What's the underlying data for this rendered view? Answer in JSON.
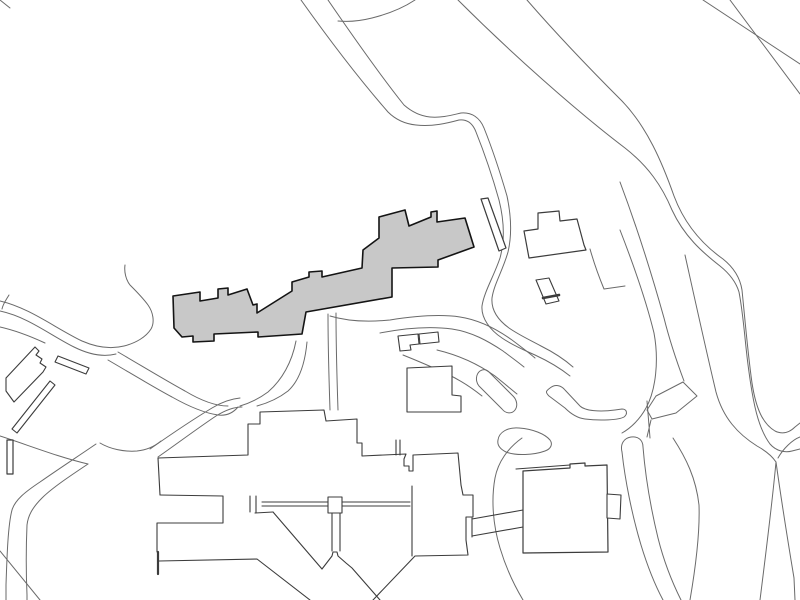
{
  "canvas": {
    "width": 800,
    "height": 600,
    "background": "#ffffff"
  },
  "palette": {
    "road_stroke": "#6a6a6a",
    "building_stroke": "#3c3c3c",
    "highlight_fill": "#c8c8c8",
    "highlight_stroke": "#141414",
    "white_fill": "#ffffff"
  },
  "shapes": [
    {
      "name": "corner-tick-road",
      "kind": "road",
      "fill": "none",
      "stroke": "#6a6a6a",
      "width": 1,
      "d": "M0,0 L10,8"
    },
    {
      "name": "road-top-right-edge-1",
      "kind": "road",
      "fill": "none",
      "stroke": "#6a6a6a",
      "width": 1,
      "d": "M703,0 L800,64"
    },
    {
      "name": "road-top-right-edge-2",
      "kind": "road",
      "fill": "none",
      "stroke": "#6a6a6a",
      "width": 1,
      "d": "M730,0 L800,94"
    },
    {
      "name": "main-road-edge-west",
      "kind": "road",
      "fill": "none",
      "stroke": "#6a6a6a",
      "width": 1,
      "d": "M458,0 C510,52 575,110 625,148 C648,166 662,186 672,210 C684,236 702,252 720,266 C730,274 736,282 739,292 C744,318 745,345 749,372 C753,402 758,428 770,444 C776,451 785,453 792,451 L800,449"
    },
    {
      "name": "main-road-edge-east",
      "kind": "road",
      "fill": "none",
      "stroke": "#6a6a6a",
      "width": 1,
      "d": "M527,0 C560,38 595,74 622,101 C647,127 662,162 674,196 C686,228 706,247 723,259 C733,267 740,277 742,290 C745,320 748,355 752,383 C756,409 763,424 775,431 C783,435 790,432 795,427 L800,423"
    },
    {
      "name": "road-branch-inner-edge",
      "kind": "road",
      "fill": "none",
      "stroke": "#6a6a6a",
      "width": 1,
      "d": "M685,255 C695,300 706,350 716,392 C723,418 738,434 757,446 C766,451 772,456 776,462 C772,505 766,552 760,600"
    },
    {
      "name": "road-crossing-from-right",
      "kind": "road",
      "fill": "none",
      "stroke": "#6a6a6a",
      "width": 1,
      "d": "M800,437 C792,440 783,449 778,458"
    },
    {
      "name": "road-descender-right",
      "kind": "road",
      "fill": "none",
      "stroke": "#6a6a6a",
      "width": 1,
      "d": "M776,462 C782,505 789,548 794,578 L795,600"
    },
    {
      "name": "road-curve-c-edge",
      "kind": "road",
      "fill": "none",
      "stroke": "#6a6a6a",
      "width": 1,
      "d": "M620,182 C638,230 652,275 664,318 C670,342 678,365 684,381"
    },
    {
      "name": "road-curve-d-edge",
      "kind": "road",
      "fill": "none",
      "stroke": "#6a6a6a",
      "width": 1,
      "d": "M620,230 C634,266 646,300 654,333 C659,360 656,390 646,408 C640,419 631,428 622,433"
    },
    {
      "name": "median-island-left-edge",
      "kind": "road",
      "fill": "none",
      "stroke": "#6a6a6a",
      "width": 1,
      "d": "M622,452 C620,444 624,438 631,437 C638,436 643,440 643,447 C645,472 650,505 658,538 C664,562 672,582 681,600"
    },
    {
      "name": "median-island-right-edge",
      "kind": "road",
      "fill": "none",
      "stroke": "#6a6a6a",
      "width": 1,
      "d": "M622,452 C625,480 632,515 641,545 C648,568 655,585 663,600"
    },
    {
      "name": "road-center-descender",
      "kind": "road",
      "fill": "none",
      "stroke": "#6a6a6a",
      "width": 1,
      "d": "M673,438 C686,458 696,478 699,505 C700,532 696,565 690,600"
    },
    {
      "name": "road-island-connector",
      "kind": "road",
      "fill": "none",
      "stroke": "#6a6a6a",
      "width": 1,
      "d": "M651,420 L647,437 M647,401 C648,414 649,426 650,438"
    },
    {
      "name": "junction-arrow-island",
      "kind": "island",
      "fill": "none",
      "stroke": "#6a6a6a",
      "width": 1,
      "d": "M683,382 L697,396 L676,413 L652,419 L647,410 L656,396 Z"
    },
    {
      "name": "junction-boomerang-island",
      "kind": "island",
      "fill": "none",
      "stroke": "#6a6a6a",
      "width": 1,
      "d": "M550,388 C555,384 561,385 565,390 L580,406 C585,411 600,412 615,410 L622,409 C627,409 628,414 624,417 C619,420 600,421 585,419 C577,418 570,413 565,408 L549,396 C545,392 546,391 550,388 Z"
    },
    {
      "name": "walkway-capsule-island",
      "kind": "island",
      "fill": "none",
      "stroke": "#6a6a6a",
      "width": 1,
      "d": "M480,371 C476,374 475,381 479,386 L502,409 C506,414 512,414 515,410 C518,406 517,400 513,396 L489,372 C486,369 483,369 480,371 Z"
    },
    {
      "name": "pond",
      "kind": "pond",
      "fill": "#ffffff",
      "stroke": "#6a6a6a",
      "width": 1,
      "d": "M498,440 C499,432 508,427 519,428 C533,429 545,434 550,440 C553,444 551,449 545,451 C534,455 516,456 506,452 C500,449 497,445 498,440 Z"
    },
    {
      "name": "path-from-top-outer",
      "kind": "path",
      "fill": "none",
      "stroke": "#6a6a6a",
      "width": 1,
      "d": "M301,0 C328,38 360,80 388,112 C396,120 406,124 416,125 C432,127 448,123 459,120 C468,119 473,124 476,132 C484,152 492,175 499,200 C504,220 505,240 500,258 C494,276 484,292 482,306 C481,318 490,330 502,338 C512,345 524,350 535,355 C548,361 560,368 570,376"
    },
    {
      "name": "path-from-top-inner",
      "kind": "path",
      "fill": "none",
      "stroke": "#6a6a6a",
      "width": 1,
      "d": "M328,0 C352,35 380,75 404,105 C412,112 420,116 430,117 C442,118 452,115 461,113 C472,112 480,118 484,128 C492,148 500,172 507,196 C511,215 512,235 508,252 C503,270 494,284 492,298 C491,310 498,320 509,328 C519,335 530,340 541,346 C553,352 564,359 573,367"
    },
    {
      "name": "path-merge-lane",
      "kind": "path",
      "fill": "none",
      "stroke": "#6a6a6a",
      "width": 1,
      "d": "M415,0 C403,8 388,14 372,18 C360,21 348,22 338,21"
    },
    {
      "name": "yard-wall-line",
      "kind": "path",
      "fill": "none",
      "stroke": "#6a6a6a",
      "width": 1,
      "d": "M590,249 C594,263 599,277 604,289 L625,286"
    },
    {
      "name": "path-below-building-1",
      "kind": "path",
      "fill": "none",
      "stroke": "#6a6a6a",
      "width": 1,
      "d": "M330,316 C350,322 370,322 390,320 C415,316 440,314 460,317 C480,320 498,330 512,340 C520,346 528,352 535,358"
    },
    {
      "name": "path-below-building-2",
      "kind": "path",
      "fill": "none",
      "stroke": "#6a6a6a",
      "width": 1,
      "d": "M380,333 C405,328 430,326 452,329 C472,332 488,341 503,351 C511,357 518,362 524,367"
    },
    {
      "name": "path-small-rect-se-1",
      "kind": "path",
      "fill": "none",
      "stroke": "#6a6a6a",
      "width": 1,
      "d": "M437,350 C458,355 478,364 495,376 C505,384 512,390 517,394"
    },
    {
      "name": "path-small-rect-se-2",
      "kind": "path",
      "fill": "none",
      "stroke": "#6a6a6a",
      "width": 1,
      "d": "M403,355 C418,361 432,367 447,374 C460,380 472,388 482,396"
    },
    {
      "name": "path-building-down-west-1",
      "kind": "path",
      "fill": "none",
      "stroke": "#6a6a6a",
      "width": 1,
      "d": "M296,341 C292,362 282,380 268,392 C260,398 250,403 240,406"
    },
    {
      "name": "path-building-down-west-2",
      "kind": "path",
      "fill": "none",
      "stroke": "#6a6a6a",
      "width": 1,
      "d": "M307,342 C305,364 299,381 288,391 C279,398 268,403 257,406"
    },
    {
      "name": "path-building-down-mid-1",
      "kind": "path",
      "fill": "none",
      "stroke": "#6a6a6a",
      "width": 1,
      "d": "M328,314 C328,348 329,380 330,410"
    },
    {
      "name": "path-building-down-mid-2",
      "kind": "path",
      "fill": "none",
      "stroke": "#6a6a6a",
      "width": 1,
      "d": "M336,313 C336,348 337,380 338,410"
    },
    {
      "name": "path-west-loop",
      "kind": "path",
      "fill": "none",
      "stroke": "#6a6a6a",
      "width": 1,
      "d": "M0,301 C30,308 55,328 82,341 C98,348 112,349 124,346 C136,343 146,337 151,329 C155,322 153,312 148,305 C143,298 136,291 130,285 C126,280 124,272 125,265"
    },
    {
      "name": "path-west-inner",
      "kind": "path",
      "fill": "none",
      "stroke": "#6a6a6a",
      "width": 1,
      "d": "M0,311 C28,317 50,335 74,347 C90,355 104,357 116,354"
    },
    {
      "name": "path-west-stub",
      "kind": "path",
      "fill": "none",
      "stroke": "#6a6a6a",
      "width": 1,
      "d": "M0,327 C18,331 32,337 45,343"
    },
    {
      "name": "path-west-corner-stub",
      "kind": "path",
      "fill": "none",
      "stroke": "#6a6a6a",
      "width": 1,
      "d": "M9,295 C6,300 3,304 2,309"
    },
    {
      "name": "path-to-complex-1",
      "kind": "path",
      "fill": "none",
      "stroke": "#6a6a6a",
      "width": 1,
      "d": "M118,352 C142,366 165,380 185,391 C200,400 215,406 228,406"
    },
    {
      "name": "path-to-complex-2",
      "kind": "path",
      "fill": "none",
      "stroke": "#6a6a6a",
      "width": 1,
      "d": "M108,360 C132,374 155,388 172,397 C188,406 204,413 218,415 C226,416 233,413 238,407"
    },
    {
      "name": "path-junction-ne-1",
      "kind": "path",
      "fill": "none",
      "stroke": "#6a6a6a",
      "width": 1,
      "d": "M150,449 C170,435 192,420 212,408 C220,403 230,399 240,398"
    },
    {
      "name": "path-junction-ne-2",
      "kind": "path",
      "fill": "none",
      "stroke": "#6a6a6a",
      "width": 1,
      "d": "M158,457 C178,443 198,428 216,416 C224,411 233,407 242,407"
    },
    {
      "name": "path-junction-arc",
      "kind": "path",
      "fill": "none",
      "stroke": "#6a6a6a",
      "width": 1,
      "d": "M100,443 C110,449 124,452 137,451 C147,450 155,446 161,441"
    },
    {
      "name": "path-sw-elbow-1",
      "kind": "path",
      "fill": "none",
      "stroke": "#6a6a6a",
      "width": 1,
      "d": "M96,444 C80,455 60,468 40,482 C25,492 15,500 12,510 C8,525 7,555 6,585 L6,600"
    },
    {
      "name": "path-sw-elbow-2",
      "kind": "path",
      "fill": "none",
      "stroke": "#6a6a6a",
      "width": 1,
      "d": "M88,464 C70,476 52,488 42,498 C32,508 28,516 27,525 C26,548 26,572 27,595 L27,600"
    },
    {
      "name": "path-sw-from-west",
      "kind": "path",
      "fill": "none",
      "stroke": "#6a6a6a",
      "width": 1,
      "d": "M0,436 C28,445 58,457 88,464"
    },
    {
      "name": "path-sw-cross-line",
      "kind": "path",
      "fill": "none",
      "stroke": "#6a6a6a",
      "width": 1,
      "d": "M0,551 L40,600"
    },
    {
      "name": "path-around-square-building",
      "kind": "path",
      "fill": "none",
      "stroke": "#6a6a6a",
      "width": 1,
      "d": "M522,438 C508,448 498,462 495,478 C491,500 493,525 500,548 C506,568 514,585 523,600"
    },
    {
      "name": "complex-upper-outline",
      "kind": "building",
      "fill": "none",
      "stroke": "#3c3c3c",
      "width": 1.1,
      "d": "M160,495 L158,458 L248,455 L248,424 L260,424 L260,412 L324,410 L326,421 L357,419 L357,443 L362,443 L362,456 L406,454 L404,459 L404,466 L409,466 L409,471 L413,471 L413,455 L458,453 L461,485 L463,495 L473,495 L473,517 L466,517 L466,540 L468,555 L415,556 L373,600"
    },
    {
      "name": "complex-tall-block-left-edge",
      "kind": "building",
      "fill": "none",
      "stroke": "#3c3c3c",
      "width": 1.1,
      "d": "M412,486 L412,556"
    },
    {
      "name": "complex-left-lower",
      "kind": "building",
      "fill": "none",
      "stroke": "#3c3c3c",
      "width": 1.1,
      "d": "M160,495 L223,496 L223,523 L157,523 L157,552"
    },
    {
      "name": "complex-dark-slat",
      "kind": "building",
      "fill": "none",
      "stroke": "#3c3c3c",
      "width": 2.2,
      "d": "M158,552 L158,574"
    },
    {
      "name": "complex-bottom-edge",
      "kind": "building",
      "fill": "none",
      "stroke": "#3c3c3c",
      "width": 1.1,
      "d": "M159,561 L257,559 L310,600"
    },
    {
      "name": "complex-corridor-verticals",
      "kind": "building",
      "fill": "none",
      "stroke": "#3c3c3c",
      "width": 1.1,
      "d": "M250,496 L250,512 M256,496 L256,513 M255,513 L273,512"
    },
    {
      "name": "complex-corridor-lines",
      "kind": "building",
      "fill": "none",
      "stroke": "#3c3c3c",
      "width": 1.1,
      "d": "M262,502 L410,502 M262,506 L410,506"
    },
    {
      "name": "complex-diagonal-arm",
      "kind": "building",
      "fill": "none",
      "stroke": "#3c3c3c",
      "width": 1.1,
      "d": "M273,512 L322,569"
    },
    {
      "name": "complex-chevron-wing",
      "kind": "building",
      "fill": "none",
      "stroke": "#3c3c3c",
      "width": 1.1,
      "d": "M322,569 L332,556 L333,552 L337,552 L338,556 L346,563 L352,568 L380,600"
    },
    {
      "name": "complex-stair-box",
      "kind": "building",
      "fill": "#ffffff",
      "stroke": "#3c3c3c",
      "width": 1.1,
      "d": "M328,497 L342,497 L342,513 L328,513 Z"
    },
    {
      "name": "complex-link-verticals",
      "kind": "building",
      "fill": "none",
      "stroke": "#3c3c3c",
      "width": 1.1,
      "d": "M332,513 L332,551 M340,513 L340,551"
    },
    {
      "name": "complex-walkway-bridge",
      "kind": "building",
      "fill": "none",
      "stroke": "#3c3c3c",
      "width": 1.1,
      "d": "M472,518 L472,537 M472,519 L523,510 M472,536 L523,527"
    },
    {
      "name": "complex-north-rect",
      "kind": "building",
      "fill": "#ffffff",
      "stroke": "#3c3c3c",
      "width": 1.1,
      "d": "M407,412 L407,368 L452,366 L452,395 L461,396 L461,412 Z"
    },
    {
      "name": "complex-north-connectors",
      "kind": "building",
      "fill": "none",
      "stroke": "#3c3c3c",
      "width": 1.1,
      "d": "M396,440 L396,455 M400,440 L400,455"
    },
    {
      "name": "square-building-outer-line",
      "kind": "building",
      "fill": "none",
      "stroke": "#3c3c3c",
      "width": 1.1,
      "d": "M516,469 L570,465"
    },
    {
      "name": "square-building",
      "kind": "building",
      "fill": "#ffffff",
      "stroke": "#3c3c3c",
      "width": 1.2,
      "d": "M523,471 L570,468 L570,464 L585,463 L585,466 L607,465 L608,552 L523,553 Z"
    },
    {
      "name": "square-building-annex",
      "kind": "building",
      "fill": "#ffffff",
      "stroke": "#3c3c3c",
      "width": 1.1,
      "d": "M607,494 L621,495 L620,519 L607,518 Z"
    },
    {
      "name": "slat-building",
      "kind": "building",
      "fill": "#ffffff",
      "stroke": "#3c3c3c",
      "width": 1.2,
      "d": "M481,199 L488,198 L506,248 L499,251 Z"
    },
    {
      "name": "house-building",
      "kind": "building",
      "fill": "#ffffff",
      "stroke": "#3c3c3c",
      "width": 1.2,
      "d": "M524,231 L538,229 L538,213 L559,211 L560,221 L577,219 L584,245 L586,250 L529,258 Z"
    },
    {
      "name": "small-building-with-band",
      "kind": "building",
      "fill": "#ffffff",
      "stroke": "#3c3c3c",
      "width": 1.1,
      "d": "M536,280 L549,278 L559,301 L546,304 Z"
    },
    {
      "name": "small-building-band",
      "kind": "building",
      "fill": "none",
      "stroke": "#3c3c3c",
      "width": 2.6,
      "d": "M543,298 L559,295"
    },
    {
      "name": "small-l-building",
      "kind": "building",
      "fill": "#ffffff",
      "stroke": "#3c3c3c",
      "width": 1.1,
      "d": "M398,336 L418,334 L419,344 L410,345 L411,350 L400,351 Z"
    },
    {
      "name": "small-rect-building",
      "kind": "building",
      "fill": "#ffffff",
      "stroke": "#3c3c3c",
      "width": 1.1,
      "d": "M419,334 L438,332 L439,342 L420,344 Z"
    },
    {
      "name": "west-bar-building",
      "kind": "building",
      "fill": "#ffffff",
      "stroke": "#3c3c3c",
      "width": 1.1,
      "d": "M6,378 L35,347 L39,351 L36,355 L42,359 L40,363 L46,367 L43,372 L14,402 L6,391 Z"
    },
    {
      "name": "west-slat-diagonal",
      "kind": "building",
      "fill": "#ffffff",
      "stroke": "#3c3c3c",
      "width": 1.1,
      "d": "M50,381 L55,385 L17,433 L12,429 Z"
    },
    {
      "name": "west-slat-vertical",
      "kind": "building",
      "fill": "#ffffff",
      "stroke": "#3c3c3c",
      "width": 1.2,
      "d": "M7,440 L13,440 L13,474 L7,474 Z"
    },
    {
      "name": "west-small-slat",
      "kind": "building",
      "fill": "#ffffff",
      "stroke": "#3c3c3c",
      "width": 1.1,
      "d": "M55,362 L58,356 L89,368 L86,374 Z"
    },
    {
      "name": "highlighted-building",
      "kind": "highlight",
      "fill": "#c8c8c8",
      "stroke": "#141414",
      "width": 1.6,
      "d": "M173,296 L200,292 L200,301 L218,298 L218,289 L228,288 L228,295 L247,289 L253,305 L257,304 L257,313 L292,291 L292,282 L309,277 L309,272 L322,271 L322,277 L362,268 L363,250 L379,238 L379,217 L405,210 L409,226 L431,217 L431,212 L437,211 L437,222 L465,218 L474,247 L438,260 L438,267 L392,268 L392,297 L306,312 L302,334 L258,337 L258,332 L214,334 L214,341 L193,342 L193,336 L182,337 L174,328 Z"
    }
  ]
}
